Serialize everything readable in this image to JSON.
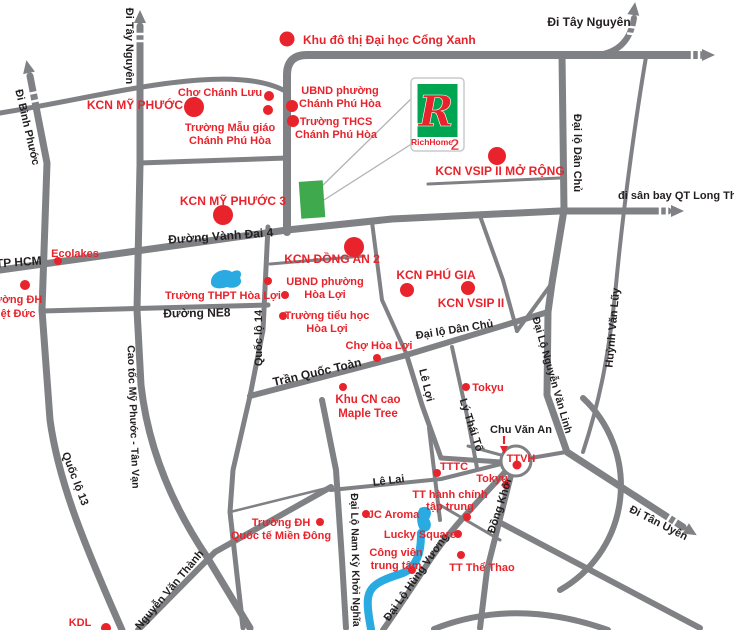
{
  "map": {
    "colors": {
      "road": "#7f8184",
      "road_thin": "#8a8c8f",
      "red": "#e8232b",
      "black": "#231f20",
      "water": "#29abe2",
      "site_green": "#3fa94d",
      "logo_green": "#00a551",
      "callout": "#b0b2b4",
      "white": "#ffffff"
    },
    "roads": [
      {
        "d": "M 30,76 L 47,163 L 42,310 L 50,420 C 58,478 80,535 122,630",
        "w": 7
      },
      {
        "d": "M 140,26 L 140,165 L 137,310 L 141,385 C 148,448 172,505 207,557 L 250,628",
        "w": 7
      },
      {
        "d": "M 287,232 L 287,75 Q 287,55 307,55 L 700,55",
        "w": 8
      },
      {
        "d": "M 598,55 Q 629,51 634,18",
        "w": 6
      },
      {
        "d": "M 646,57 C 637,110 624,200 616,285 C 609,355 600,400 583,452",
        "w": 4
      },
      {
        "d": "M 0,270 C 95,257 190,243 287,230 L 392,219 L 560,211 L 668,211",
        "w": 7
      },
      {
        "d": "M 139,163 L 287,158",
        "w": 5
      },
      {
        "d": "M 42,311 L 268,305",
        "w": 5
      },
      {
        "d": "M 268,227 L 263,330 L 250,396 L 233,470 L 230,512 L 237,575 L 243,628",
        "w": 5
      },
      {
        "d": "M 250,396 L 403,356 L 548,312",
        "w": 6
      },
      {
        "d": "M 562,55 L 564,210 L 552,283 L 548,312",
        "w": 7
      },
      {
        "d": "M 548,312 L 547,395 L 567,452 L 683,527",
        "w": 7
      },
      {
        "d": "M 406,353 L 422,405 L 441,458 L 501,462",
        "w": 5
      },
      {
        "d": "M 452,347 L 468,420 L 477,468",
        "w": 4
      },
      {
        "d": "M 511,475 L 487,570 L 480,628",
        "w": 6
      },
      {
        "d": "M 331,490 L 441,479 L 501,464",
        "w": 4
      },
      {
        "d": "M 322,400 L 336,470 L 342,560 L 346,628",
        "w": 6
      },
      {
        "d": "M 138,630 L 215,552 L 331,487",
        "w": 6
      },
      {
        "d": "M 507,470 C 472,508 450,530 430,560 C 415,583 400,606 383,630",
        "w": 6
      },
      {
        "d": "M 429,428 L 440,520",
        "w": 4
      },
      {
        "d": "M 440,505 L 500,540",
        "w": 3
      },
      {
        "d": "M 501,455 L 468,446",
        "w": 3
      },
      {
        "d": "M 531,458 L 566,452",
        "w": 4
      },
      {
        "d": "M 583,398 A 120 120 0 0 1 560,590",
        "w": 6
      },
      {
        "d": "M 434,629 Q 515,597 608,630",
        "w": 6
      },
      {
        "d": "M 499,522 L 700,628",
        "w": 6
      },
      {
        "d": "M 428,184 L 560,178",
        "w": 3
      },
      {
        "d": "M 270,264 L 364,256",
        "w": 3
      },
      {
        "d": "M 372,222 L 382,300 L 406,353",
        "w": 4
      },
      {
        "d": "M 480,216 L 503,280 L 517,331",
        "w": 4
      },
      {
        "d": "M 517,331 L 552,283",
        "w": 4
      },
      {
        "d": "M 230,512 L 331,487",
        "w": 2.5
      },
      {
        "d": "M 0,113 C 70,102 140,84 200,80 C 240,77 268,81 287,92",
        "w": 5
      }
    ],
    "arrows": [
      {
        "x": 28,
        "y": 68,
        "rot": -12
      },
      {
        "x": 140,
        "y": 18,
        "rot": 0
      },
      {
        "x": 634,
        "y": 10,
        "rot": 8
      },
      {
        "x": 707,
        "y": 55,
        "rot": 90
      },
      {
        "x": 676,
        "y": 211,
        "rot": 90
      },
      {
        "x": 690,
        "y": 531,
        "rot": 122
      }
    ],
    "hashes": [
      {
        "x": 33,
        "y": 93,
        "rot": -12
      },
      {
        "x": 35,
        "y": 101,
        "rot": -12
      },
      {
        "x": 140,
        "y": 34,
        "rot": 0
      },
      {
        "x": 140,
        "y": 41,
        "rot": 0
      },
      {
        "x": 631,
        "y": 27,
        "rot": 8
      },
      {
        "x": 632,
        "y": 34,
        "rot": 8
      },
      {
        "x": 692,
        "y": 55,
        "rot": 90
      },
      {
        "x": 699,
        "y": 55,
        "rot": 90
      },
      {
        "x": 660,
        "y": 211,
        "rot": 90
      },
      {
        "x": 667,
        "y": 211,
        "rot": 90
      },
      {
        "x": 669,
        "y": 518,
        "rot": 122
      },
      {
        "x": 675,
        "y": 522,
        "rot": 122
      }
    ],
    "water": [
      {
        "d": "M 211,281 C 212,272 224,267 232,272 C 239,268 243,272 240,278 C 244,284 236,290 227,287 C 218,290 210,288 211,281 Z",
        "fill": true
      },
      {
        "d": "M 420,508 C 429,504 434,511 429,519 C 434,527 428,534 421,531 C 416,525 416,513 420,508 Z",
        "fill": true
      },
      {
        "d": "M 371,629 C 366,602 365,590 380,582 C 396,573 406,576 414,564 C 420,555 421,545 421,533",
        "fill": false,
        "w": 8
      }
    ],
    "site": {
      "x": 300,
      "y": 181,
      "w": 24,
      "h": 37,
      "rot": -4
    },
    "callouts": [
      {
        "x1": 322,
        "y1": 186,
        "x2": 413,
        "y2": 97
      },
      {
        "x1": 324,
        "y1": 200,
        "x2": 413,
        "y2": 143
      }
    ],
    "roundabout": {
      "cx": 516,
      "cy": 461,
      "r": 15
    },
    "pointer": {
      "x": 504,
      "y1": 436,
      "y2": 444,
      "tip": 449
    },
    "dots": [
      {
        "x": 287,
        "y": 39,
        "r": 7.5
      },
      {
        "x": 194,
        "y": 107,
        "r": 10
      },
      {
        "x": 269,
        "y": 96,
        "r": 5
      },
      {
        "x": 268,
        "y": 110,
        "r": 5
      },
      {
        "x": 292,
        "y": 106,
        "r": 6
      },
      {
        "x": 293,
        "y": 121,
        "r": 6
      },
      {
        "x": 223,
        "y": 215,
        "r": 10
      },
      {
        "x": 497,
        "y": 156,
        "r": 9
      },
      {
        "x": 58,
        "y": 261,
        "r": 4
      },
      {
        "x": 25,
        "y": 285,
        "r": 5
      },
      {
        "x": 354,
        "y": 247,
        "r": 10
      },
      {
        "x": 268,
        "y": 281,
        "r": 4
      },
      {
        "x": 285,
        "y": 295,
        "r": 4
      },
      {
        "x": 283,
        "y": 316,
        "r": 4
      },
      {
        "x": 407,
        "y": 290,
        "r": 7
      },
      {
        "x": 468,
        "y": 288,
        "r": 7
      },
      {
        "x": 377,
        "y": 358,
        "r": 4
      },
      {
        "x": 343,
        "y": 387,
        "r": 4
      },
      {
        "x": 466,
        "y": 387,
        "r": 4
      },
      {
        "x": 437,
        "y": 473,
        "r": 4
      },
      {
        "x": 517,
        "y": 465,
        "r": 4.5
      },
      {
        "x": 506,
        "y": 485,
        "r": 4
      },
      {
        "x": 467,
        "y": 517,
        "r": 4
      },
      {
        "x": 366,
        "y": 514,
        "r": 4
      },
      {
        "x": 320,
        "y": 522,
        "r": 4
      },
      {
        "x": 458,
        "y": 534,
        "r": 4
      },
      {
        "x": 412,
        "y": 570,
        "r": 4
      },
      {
        "x": 461,
        "y": 555,
        "r": 4
      },
      {
        "x": 106,
        "y": 628,
        "r": 5
      }
    ],
    "poi_labels": [
      {
        "lines": [
          "Khu đô thị Đại học Cổng Xanh"
        ],
        "x": 303,
        "y": 44,
        "size": 12,
        "anchor": "start"
      },
      {
        "lines": [
          "Chợ Chánh Lưu"
        ],
        "x": 220,
        "y": 96,
        "size": 11
      },
      {
        "lines": [
          "KCN MỸ PHƯỚC 2"
        ],
        "x": 140,
        "y": 109,
        "size": 12
      },
      {
        "lines": [
          "Trường Mẫu giáo",
          "Chánh Phú Hòa"
        ],
        "x": 230,
        "y": 131,
        "size": 11,
        "lh": 13
      },
      {
        "lines": [
          "UBND phường",
          "Chánh Phú Hòa"
        ],
        "x": 340,
        "y": 94,
        "size": 11,
        "lh": 13
      },
      {
        "lines": [
          "Trường THCS",
          "Chánh Phú Hòa"
        ],
        "x": 336,
        "y": 125,
        "size": 11,
        "lh": 13
      },
      {
        "lines": [
          "KCN MỸ PHƯỚC 3"
        ],
        "x": 233,
        "y": 205,
        "size": 12
      },
      {
        "lines": [
          "KCN VSIP II MỞ RỘNG"
        ],
        "x": 500,
        "y": 175,
        "size": 12
      },
      {
        "lines": [
          "Ecolakes"
        ],
        "x": 75,
        "y": 257,
        "size": 11
      },
      {
        "lines": [
          "Trường ĐH",
          "Việt Đức"
        ],
        "x": 13,
        "y": 303,
        "size": 11,
        "lh": 14
      },
      {
        "lines": [
          "KCN ĐỒNG AN 2"
        ],
        "x": 332,
        "y": 263,
        "size": 12
      },
      {
        "lines": [
          "UBND phường",
          "Hòa Lợi"
        ],
        "x": 325,
        "y": 285,
        "size": 11,
        "lh": 13
      },
      {
        "lines": [
          "Trường THPT Hòa Lợi"
        ],
        "x": 223,
        "y": 299,
        "size": 11
      },
      {
        "lines": [
          "Trường tiểu học",
          "Hòa Lợi"
        ],
        "x": 327,
        "y": 319,
        "size": 11,
        "lh": 13
      },
      {
        "lines": [
          "KCN PHÚ GIA"
        ],
        "x": 436,
        "y": 279,
        "size": 12
      },
      {
        "lines": [
          "KCN VSIP II"
        ],
        "x": 471,
        "y": 307,
        "size": 12
      },
      {
        "lines": [
          "Chợ Hòa Lợi"
        ],
        "x": 379,
        "y": 349,
        "size": 11
      },
      {
        "lines": [
          "Khu CN cao",
          "Maple Tree"
        ],
        "x": 368,
        "y": 403,
        "size": 11.5,
        "lh": 14
      },
      {
        "lines": [
          "Tokyu"
        ],
        "x": 488,
        "y": 391,
        "size": 11
      },
      {
        "lines": [
          "TTTC"
        ],
        "x": 454,
        "y": 470,
        "size": 11
      },
      {
        "lines": [
          "TTVH"
        ],
        "x": 521,
        "y": 462,
        "size": 11
      },
      {
        "lines": [
          "Tokyu"
        ],
        "x": 492,
        "y": 482,
        "size": 11
      },
      {
        "lines": [
          "TT hành chính",
          "tập trung"
        ],
        "x": 450,
        "y": 498,
        "size": 11,
        "lh": 12
      },
      {
        "lines": [
          "IJC Aroma"
        ],
        "x": 392,
        "y": 518,
        "size": 11
      },
      {
        "lines": [
          "Trường ĐH",
          "Quốc tế Miền Đông"
        ],
        "x": 281,
        "y": 526,
        "size": 11,
        "lh": 13
      },
      {
        "lines": [
          "Lucky Square"
        ],
        "x": 420,
        "y": 538,
        "size": 11
      },
      {
        "lines": [
          "Công viên",
          "trung tâm"
        ],
        "x": 396,
        "y": 556,
        "size": 11,
        "lh": 13
      },
      {
        "lines": [
          "TT Thể Thao"
        ],
        "x": 482,
        "y": 571,
        "size": 11
      },
      {
        "lines": [
          "KDL"
        ],
        "x": 80,
        "y": 626,
        "size": 11
      }
    ],
    "road_labels": [
      {
        "text": "Đi Tây Nguyên",
        "x": 126,
        "y": 46,
        "rot": 90,
        "size": 11
      },
      {
        "text": "Đi Bình Phước",
        "x": 24,
        "y": 128,
        "rot": 77,
        "size": 11
      },
      {
        "text": "Đi Tây Nguyên",
        "x": 589,
        "y": 26,
        "rot": 0,
        "size": 12
      },
      {
        "text": "đi sân bay QT Long Thành",
        "x": 618,
        "y": 199,
        "rot": 0,
        "size": 11,
        "anchor": "start"
      },
      {
        "text": "Đại lộ Dân Chủ",
        "x": 574,
        "y": 153,
        "rot": 90,
        "size": 11
      },
      {
        "text": "Đường Vành Đai 4",
        "x": 221,
        "y": 240,
        "rot": -4,
        "size": 12
      },
      {
        "text": "TP HCM",
        "x": 19,
        "y": 266,
        "rot": -4,
        "size": 12
      },
      {
        "text": "Đường NE8",
        "x": 197,
        "y": 317,
        "rot": -1,
        "size": 12
      },
      {
        "text": "Quốc lộ 14",
        "x": 262,
        "y": 338,
        "rot": -90,
        "size": 11
      },
      {
        "text": "Quốc lộ 13",
        "x": 72,
        "y": 480,
        "rot": 69,
        "size": 11
      },
      {
        "text": "Cao tốc Mỹ Phước - Tân Vạn",
        "x": 130,
        "y": 417,
        "rot": 88,
        "size": 10.5
      },
      {
        "text": "Nguyễn Văn Thành",
        "x": 172,
        "y": 592,
        "rot": -50,
        "size": 11
      },
      {
        "text": "Trần Quốc Toàn",
        "x": 318,
        "y": 376,
        "rot": -13,
        "size": 12
      },
      {
        "text": "Lê Lợi",
        "x": 423,
        "y": 386,
        "rot": 76,
        "size": 11
      },
      {
        "text": "Lý Thái Tổ",
        "x": 468,
        "y": 426,
        "rot": 72,
        "size": 11
      },
      {
        "text": "Đại lộ Dân Chủ",
        "x": 455,
        "y": 333,
        "rot": -9,
        "size": 11
      },
      {
        "text": "Chu Văn An",
        "x": 521,
        "y": 433,
        "rot": 0,
        "size": 11
      },
      {
        "text": "Lê Lai",
        "x": 389,
        "y": 484,
        "rot": -7,
        "size": 11
      },
      {
        "text": "Đồng Khởi",
        "x": 503,
        "y": 507,
        "rot": -72,
        "size": 11
      },
      {
        "text": "Đại Lộ Nguyễn Văn Linh",
        "x": 549,
        "y": 376,
        "rot": 74,
        "size": 10.5
      },
      {
        "text": "Huỳnh Văn Lũy",
        "x": 616,
        "y": 328,
        "rot": -85,
        "size": 11
      },
      {
        "text": "Đại Lộ Nam Kỳ Khởi Nghĩa",
        "x": 352,
        "y": 560,
        "rot": 89,
        "size": 10.5
      },
      {
        "text": "Đại Lộ Hùng Vương",
        "x": 419,
        "y": 579,
        "rot": -55,
        "size": 11
      },
      {
        "text": "Đi Tân Uyên",
        "x": 657,
        "y": 526,
        "rot": 27,
        "size": 11
      }
    ],
    "logo": {
      "letter": "R",
      "brand": "RichHome",
      "number": "2"
    }
  }
}
